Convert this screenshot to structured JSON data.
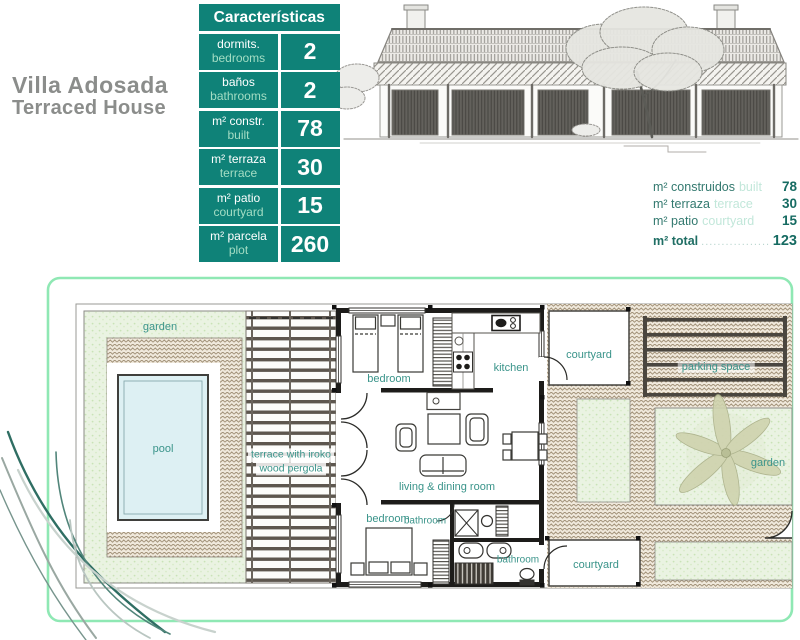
{
  "header": {
    "title_es": "Villa Adosada",
    "title_en": "Terraced House"
  },
  "characteristics": {
    "title": "Características",
    "rows": [
      {
        "label_es": "dormits.",
        "label_en": "bedrooms",
        "value": "2"
      },
      {
        "label_es": "baños",
        "label_en": "bathrooms",
        "value": "2"
      },
      {
        "label_es": "m² constr.",
        "label_en": "built",
        "value": "78"
      },
      {
        "label_es": "m² terraza",
        "label_en": "terrace",
        "value": "30"
      },
      {
        "label_es": "m² patio",
        "label_en": "courtyard",
        "value": "15"
      },
      {
        "label_es": "m² parcela",
        "label_en": "plot",
        "value": "260"
      }
    ]
  },
  "summary": {
    "rows": [
      {
        "label_es": "m² construidos",
        "label_en": "built",
        "value": "78"
      },
      {
        "label_es": "m² terraza",
        "label_en": "terrace",
        "value": "30"
      },
      {
        "label_es": "m² patio",
        "label_en": "courtyard",
        "value": "15"
      }
    ],
    "total": {
      "label": "m² total",
      "leader": "..................",
      "value": "123"
    }
  },
  "plan_labels": {
    "garden_left": "garden",
    "pool": "pool",
    "terrace_line1": "terrace with iroko",
    "terrace_line2": "wood pergola",
    "bedroom_top": "bedroom",
    "kitchen": "kitchen",
    "living": "living & dining room",
    "bedroom_bottom": "bedroom",
    "bathroom_center": "bathroom",
    "bathroom_right": "bathroom",
    "courtyard_top": "courtyard",
    "courtyard_bottom": "courtyard",
    "parking": "parking space",
    "garden_right": "garden"
  },
  "colors": {
    "brand_teal": "#0f8278",
    "pale_mint_text": "#a4ddc4",
    "plan_border_mint": "#8fe8b4",
    "label_teal": "#3a948a",
    "title_gray": "#8b8d8b",
    "pool_water": "#ddf0f3"
  }
}
